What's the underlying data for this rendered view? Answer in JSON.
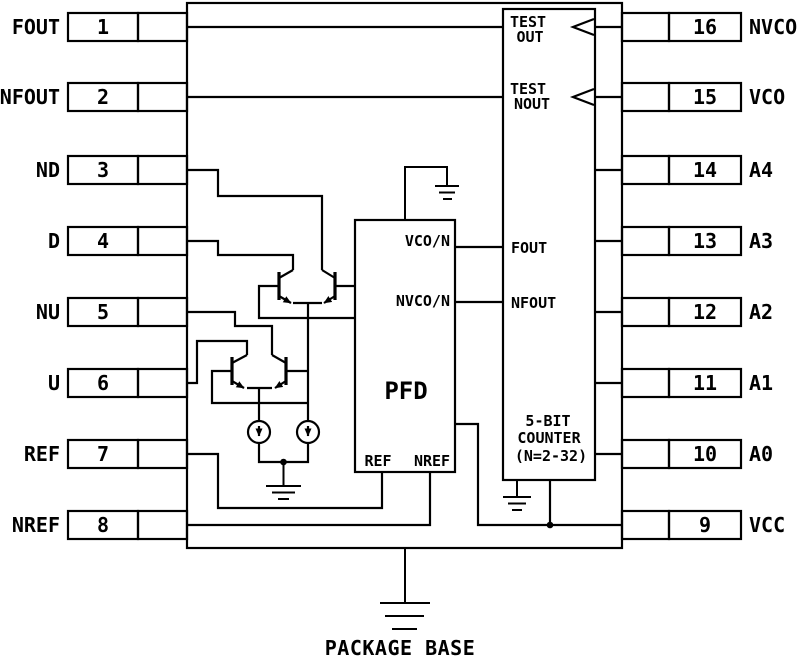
{
  "diagram": {
    "colors": {
      "line": "#000000",
      "background": "#ffffff"
    },
    "pins": {
      "left": [
        {
          "label": "FOUT",
          "number": "1"
        },
        {
          "label": "NFOUT",
          "number": "2"
        },
        {
          "label": "ND",
          "number": "3"
        },
        {
          "label": "D",
          "number": "4"
        },
        {
          "label": "NU",
          "number": "5"
        },
        {
          "label": "U",
          "number": "6"
        },
        {
          "label": "REF",
          "number": "7"
        },
        {
          "label": "NREF",
          "number": "8"
        }
      ],
      "right": [
        {
          "label": "NVCO",
          "number": "16"
        },
        {
          "label": "VCO",
          "number": "15"
        },
        {
          "label": "A4",
          "number": "14"
        },
        {
          "label": "A3",
          "number": "13"
        },
        {
          "label": "A2",
          "number": "12"
        },
        {
          "label": "A1",
          "number": "11"
        },
        {
          "label": "A0",
          "number": "10"
        },
        {
          "label": "VCC",
          "number": "9"
        }
      ]
    },
    "pfd": {
      "title": "PFD",
      "port_vco_n": "VCO/N",
      "port_nvco_n": "NVCO/N",
      "port_ref": "REF",
      "port_nref": "NREF"
    },
    "counter": {
      "test_out_line1": "TEST",
      "test_out_line2": "OUT",
      "test_nout_line1": "TEST",
      "test_nout_line2": "NOUT",
      "port_fout": "FOUT",
      "port_nfout": "NFOUT",
      "name_line1": "5-BIT",
      "name_line2": "COUNTER",
      "name_line3": "(N=2-32)"
    },
    "footer": {
      "package_label": "PACKAGE BASE"
    }
  }
}
